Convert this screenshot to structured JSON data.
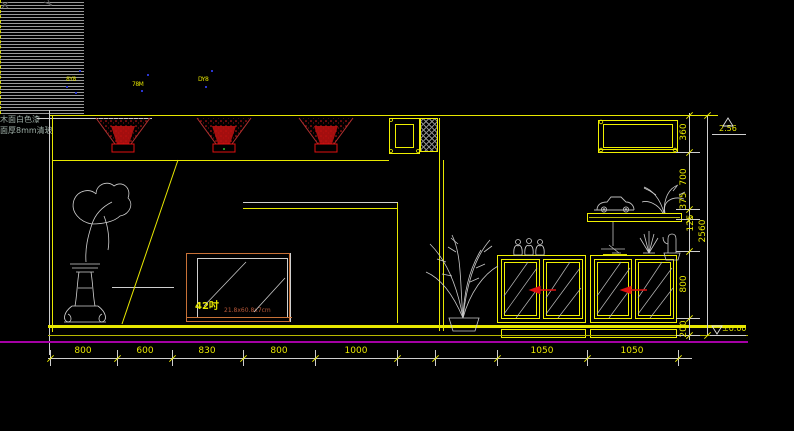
{
  "canvas": {
    "background": "#000000",
    "width": 794,
    "height": 431
  },
  "colors": {
    "line_yellow": "#f0f000",
    "line_white": "#cfcfcf",
    "floor_magenta": "#a400a4",
    "spotlight_red": "#e01010",
    "tv_border_orange": "#c87137",
    "note_text": "#9fb0a8",
    "dim_text": "#e8e800",
    "tag_blue": "#2a35d0"
  },
  "fixture_tags": [
    "8Y8",
    "78M",
    "DY8"
  ],
  "wall_note": {
    "line1": "木面白色漆",
    "line2": "面厚8mm清玻"
  },
  "tv": {
    "size_label": "42吋",
    "spec_label": "21.8x60.8x7cm"
  },
  "dims": {
    "bottom": [
      "800",
      "600",
      "830",
      "800",
      "1000",
      "1050",
      "1050"
    ],
    "right": [
      "360",
      "700",
      "375",
      "125",
      "800",
      "200"
    ],
    "right_total": "2560"
  },
  "levels": {
    "ceiling": "2.56",
    "floor": "±0.00"
  },
  "icons": [
    "spotlight-icon",
    "pedestal-plant-icon",
    "palm-plant-icon",
    "model-car-icon",
    "shelf-plant-icon",
    "cactus-icon",
    "decor-figurines-icon",
    "hanging-model-icon",
    "level-marker-icon"
  ]
}
